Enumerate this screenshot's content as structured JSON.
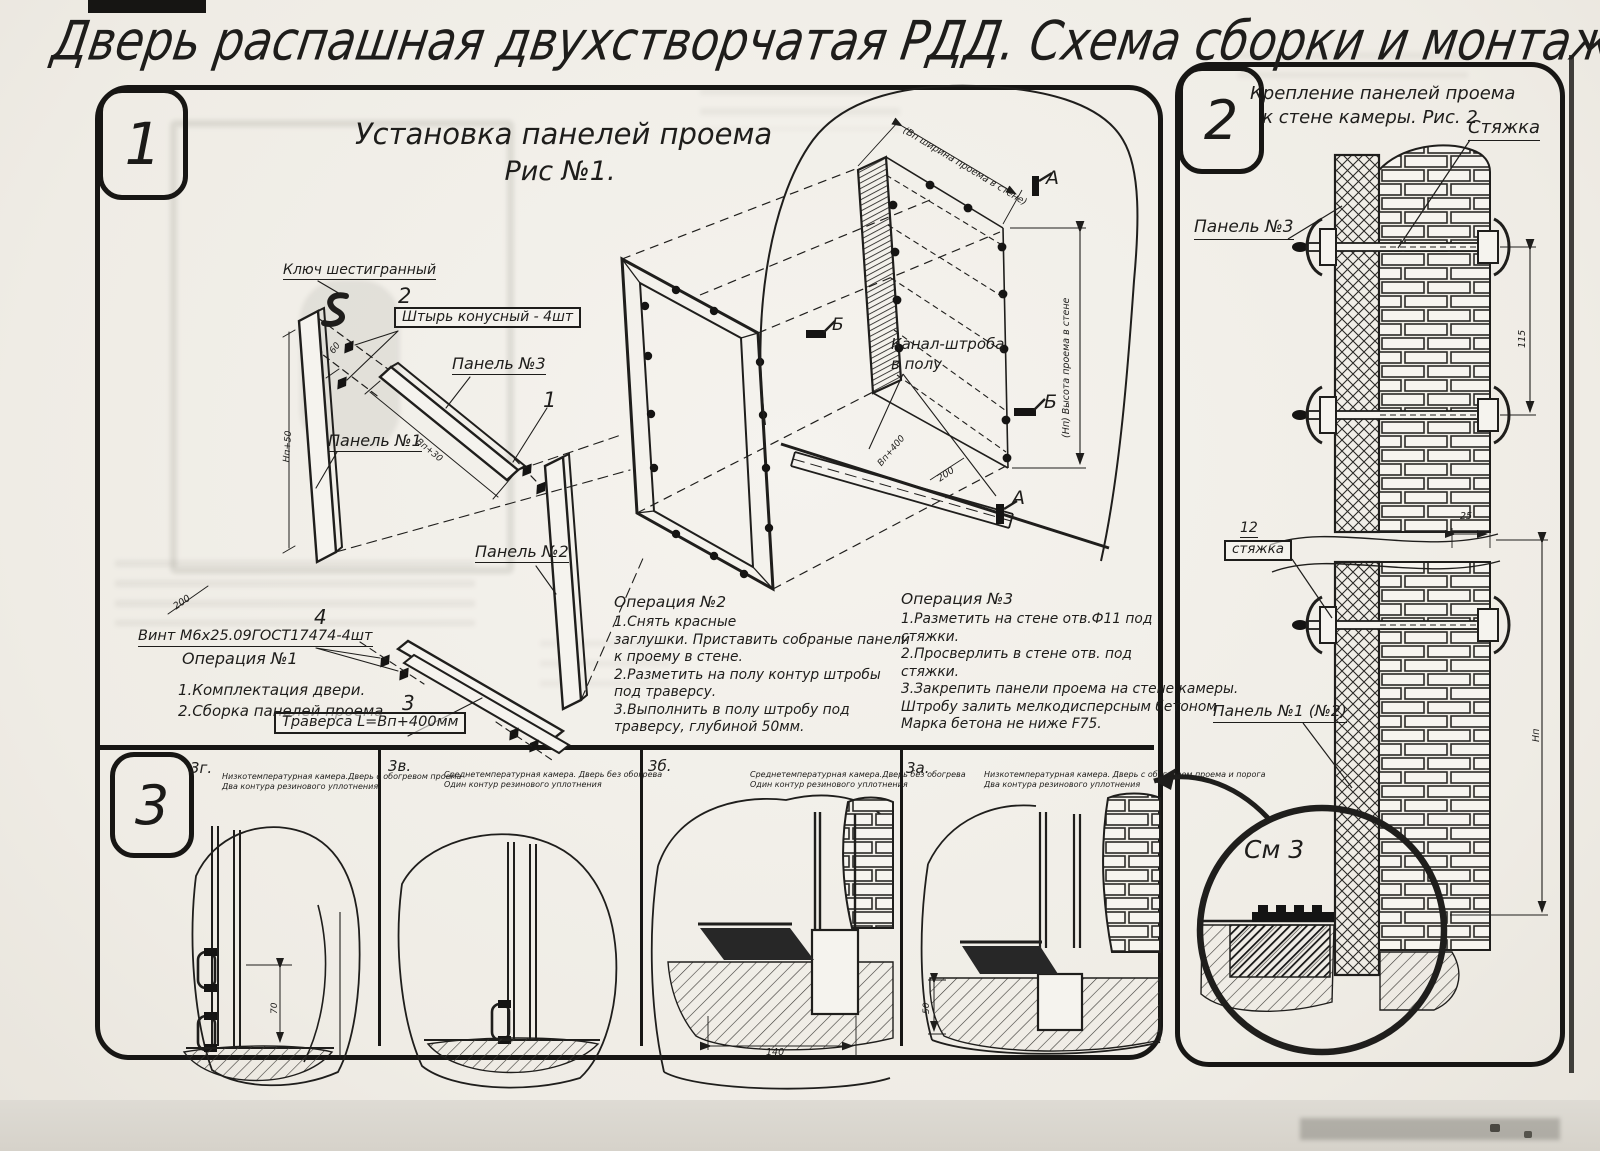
{
  "page": {
    "title": "Дверь распашная двухстворчатая РДД.  Схема сборки и монтажа №2"
  },
  "fig1": {
    "number": "1",
    "title1": "Установка панелей проема",
    "title2": "Рис №1.",
    "labels": {
      "hex_key": "Ключ шестигранный",
      "pin_num": "2",
      "pin": "Штырь конусный - 4шт",
      "panel3": "Панель №3",
      "panel1": "Панель №1",
      "panel2": "Панель №2",
      "item1": "1",
      "screw_num": "4",
      "screw": "Винт М6х25.09ГОСТ17474-4шт",
      "trav_num": "3",
      "traverse": "Траверса  L=Вп+400мм",
      "canal1": "Канал-штроба",
      "canal2": "в полу",
      "marker_a": "А",
      "marker_b": "Б"
    },
    "dims": {
      "opening_width": "(Вп ширина проема в стене)",
      "opening_height": "(Нп) Высота проема в стене",
      "d200": "200",
      "d60": "60",
      "panel1_len": "Нп+50",
      "panel3_len": "Вп+30",
      "trav_len": "Вп+400"
    },
    "op1": {
      "title": "Операция №1",
      "lines": [
        "1.Комплектация двери.",
        "2.Сборка панелей проема"
      ]
    },
    "op2": {
      "title": "Операция №2",
      "lines": [
        "1.Снять красные",
        "заглушки. Приставить собраные панели",
        "к проему в стене.",
        "2.Разметить на полу контур штробы",
        "под траверсу.",
        "3.Выполнить в полу штробу под",
        "траверсу, глубиной 50мм."
      ]
    },
    "op3": {
      "title": "Операция №3",
      "lines": [
        "1.Разметить на стене отв.Ф11 под",
        "стяжки.",
        "2.Просверлить в стене отв.  под",
        "стяжки.",
        "3.Закрепить панели проема на стене камеры.",
        "Штробу залить мелкодисперсным бетоном",
        "Марка бетона не ниже  F75."
      ]
    }
  },
  "fig2": {
    "number": "2",
    "title1": "Крепление панелей проема",
    "title2": "к стене камеры. Рис. 2",
    "labels": {
      "tie": "Стяжка",
      "panel3": "Панель №3",
      "tie_num": "12",
      "tie_box": "стяжка",
      "panel12": "Панель №1 (№2)",
      "see3": "См 3"
    },
    "dims": {
      "d25": "25",
      "d115": "115",
      "height": "Нп"
    }
  },
  "fig3": {
    "number": "3",
    "panels": [
      {
        "id": "3г.",
        "line1": "Низкотемпературная камера.Дверь с обогревом проема",
        "line2": "Два контура резинового уплотнения"
      },
      {
        "id": "3в.",
        "line1": "Среднетемпературная камера. Дверь без обогрева",
        "line2": "Один контур резинового уплотнения"
      },
      {
        "id": "3б.",
        "line1": "Среднетемпературная камера.Дверь без обогрева",
        "line2": "Один контур резинового уплотнения"
      },
      {
        "id": "3а.",
        "line1": "Низкотемпературная камера. Дверь с обогревом проема и порога",
        "line2": "Два контура резинового уплотнения"
      }
    ],
    "dims": {
      "d70": "70",
      "d140": "140",
      "d50": "50"
    }
  }
}
